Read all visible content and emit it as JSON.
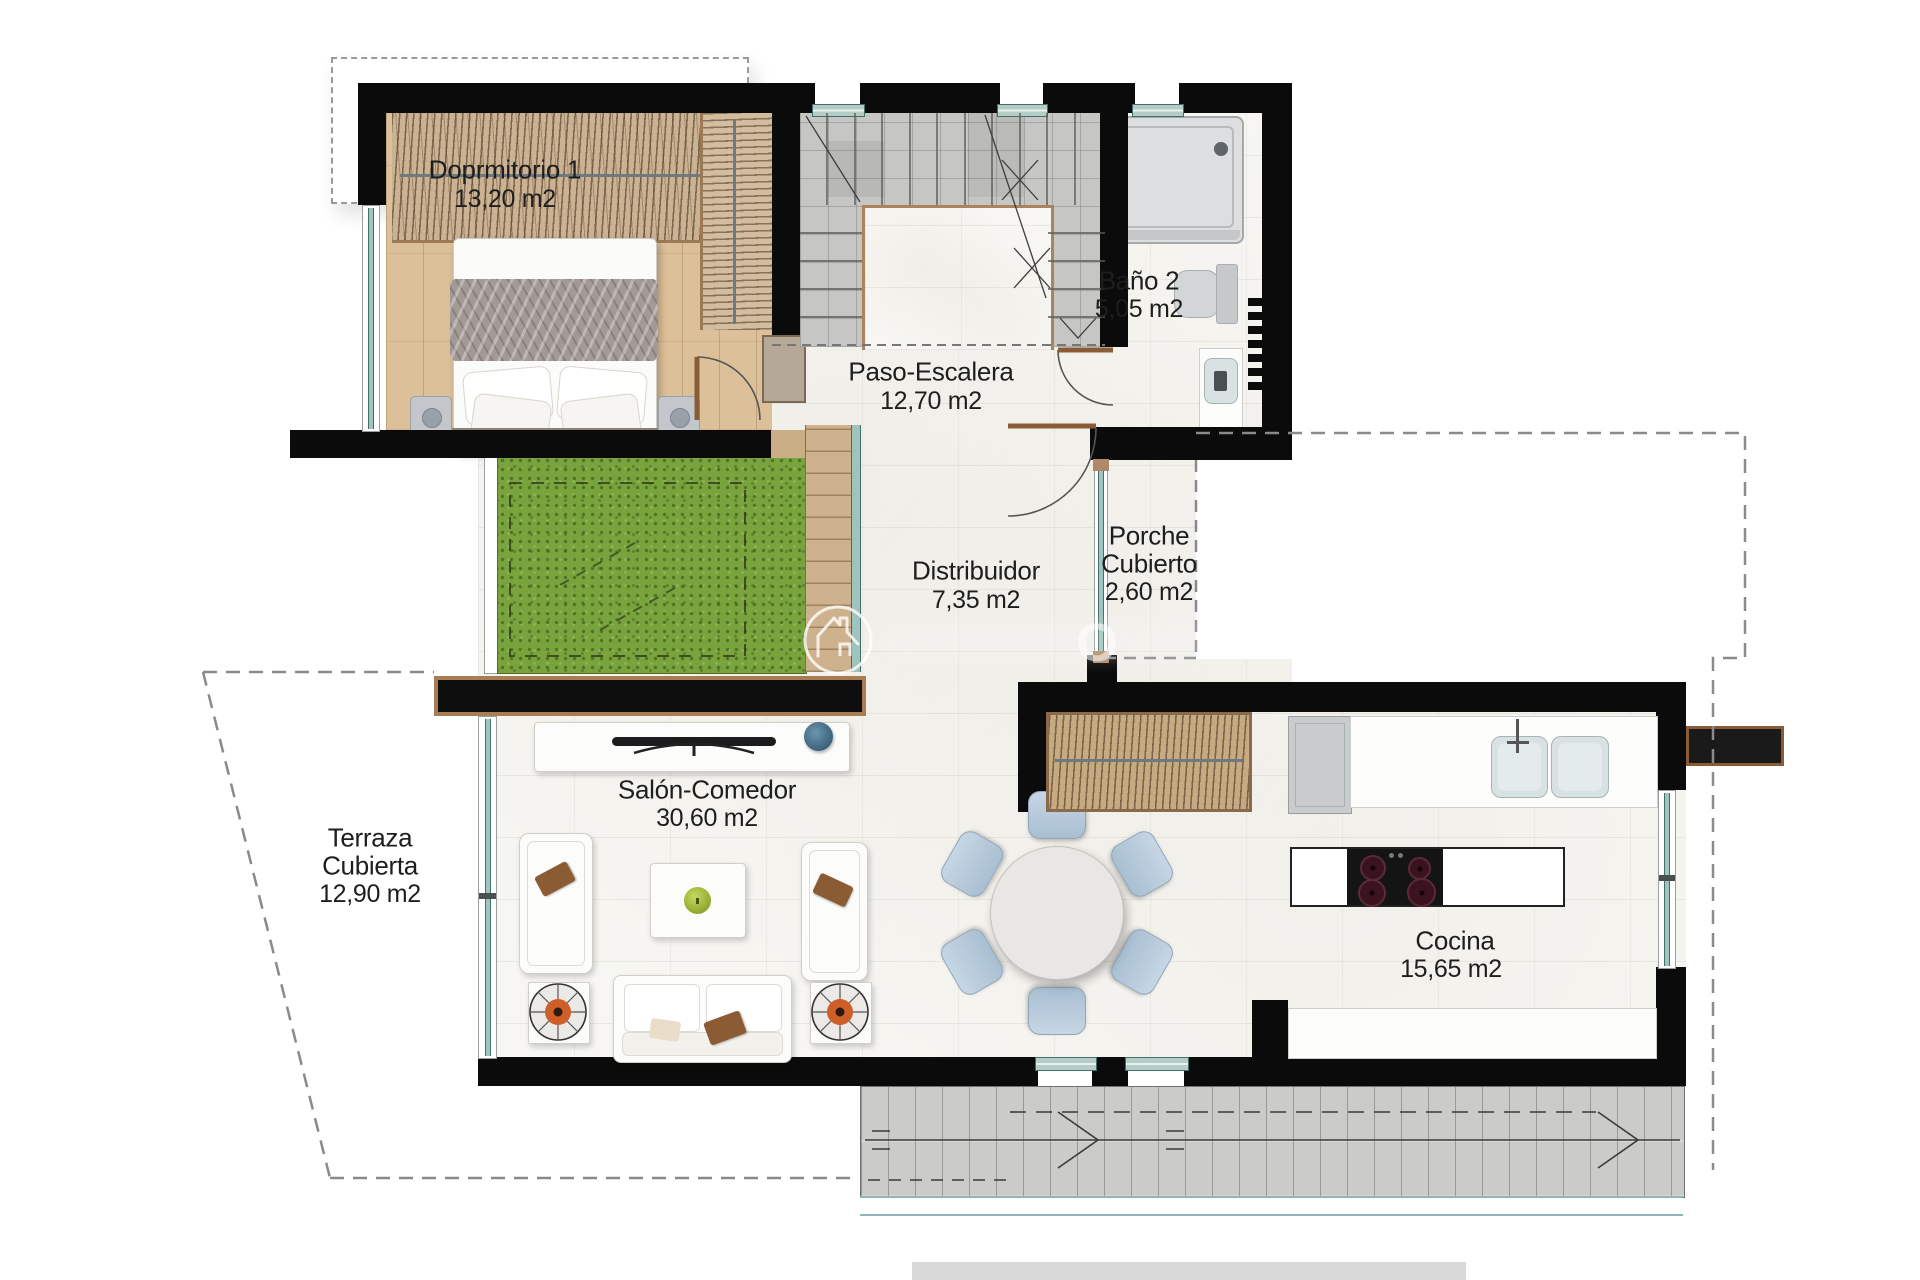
{
  "plan": {
    "title": "Planta de vivienda",
    "rooms": [
      {
        "id": "dormitorio1",
        "name": "Doprmitorio 1",
        "area": "13,20 m2"
      },
      {
        "id": "paso_escalera",
        "name": "Paso-Escalera",
        "area": "12,70 m2"
      },
      {
        "id": "bano2",
        "name": "Baño 2",
        "area": "5,05 m2"
      },
      {
        "id": "distribuidor",
        "name": "Distribuidor",
        "area": "7,35 m2"
      },
      {
        "id": "porche",
        "line1": "Porche",
        "line2": "Cubierto",
        "area": "2,60 m2"
      },
      {
        "id": "terraza",
        "line1": "Terraza",
        "line2": "Cubierta",
        "area": "12,90 m2"
      },
      {
        "id": "salon",
        "name": "Salón-Comedor",
        "area": "30,60 m2"
      },
      {
        "id": "cocina",
        "name": "Cocina",
        "area": "15,65 m2"
      }
    ],
    "watermark": {
      "logo": "house-in-circle",
      "partial_text": "O"
    },
    "colors": {
      "wall": "#0b0b0b",
      "wood_floor": "#dcc099",
      "grass": "#79a33d",
      "marble": "#f7f6f2",
      "stair_tile": "#c6c6c4",
      "window_teal": "#9fc3bd",
      "wood_trim": "#a97d52",
      "accent_orange": "#cf5f28",
      "accent_green_apple": "#9fbe3a",
      "accent_blue_vase": "#47718e",
      "chair_blue": "#b7cadb"
    }
  }
}
